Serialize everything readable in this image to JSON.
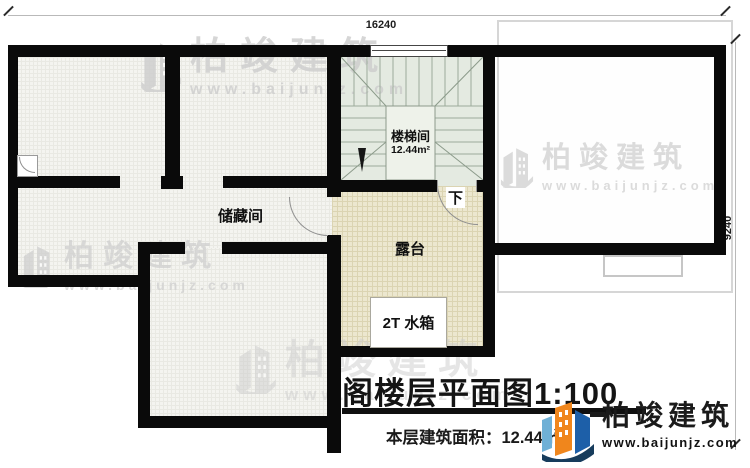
{
  "plan": {
    "dimensions": {
      "width_mm": "16240",
      "height_mm": "9240"
    },
    "rooms": {
      "storage_label": "储藏间",
      "stair_label": "楼梯间",
      "stair_area": "12.44m²",
      "stair_direction": "下",
      "terrace_label": "露台",
      "water_tank_label": "2T 水箱"
    }
  },
  "title_block": {
    "title": "阁楼层平面图1:100",
    "area_text": "本层建筑面积：12.44㎡"
  },
  "watermark": {
    "brand": "柏竣建筑",
    "url": "www.baijunjz.com"
  },
  "logo": {
    "brand": "柏竣建筑",
    "url": "www.baijunjz.com"
  },
  "colors": {
    "wall": "#0a0a0a",
    "storage_floor": "#f4f4f0",
    "stair_floor": "#e4eae1",
    "terrace_floor": "#ece7cf",
    "watermark": "#cdcdcd",
    "logo_orange": "#f0861c",
    "logo_blue": "#1d5fa8",
    "logo_lightblue": "#6fb0d6",
    "logo_navy": "#173c5c"
  }
}
